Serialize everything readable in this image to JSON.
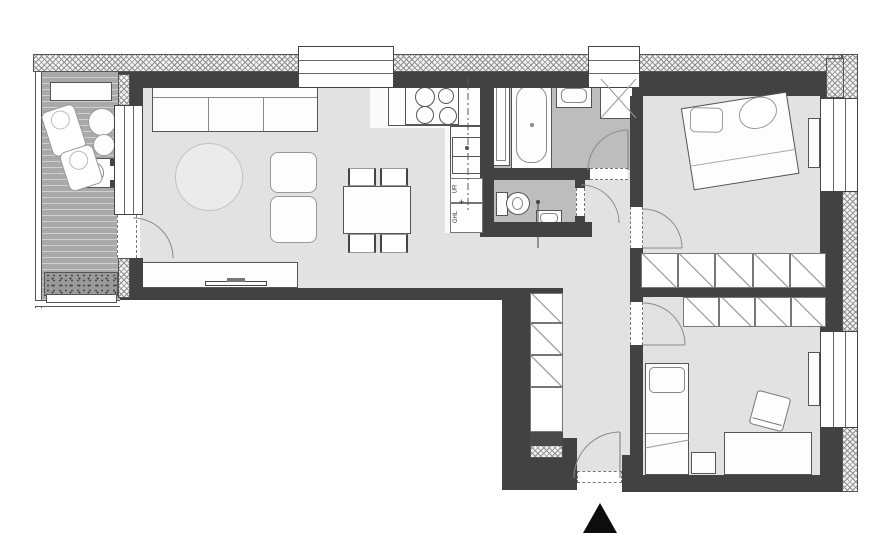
{
  "plan": {
    "kitchen_labels": {
      "upper": "UR",
      "lower": "GHL",
      "plus": "+"
    }
  },
  "colors": {
    "wall": "#424242",
    "floor": "#e2e2e2",
    "wet_room_floor": "#bdbdbd",
    "balcony_deck": "#aeaeae",
    "north_arrow": "#0d0d0d",
    "furniture_outline": "#555555"
  }
}
